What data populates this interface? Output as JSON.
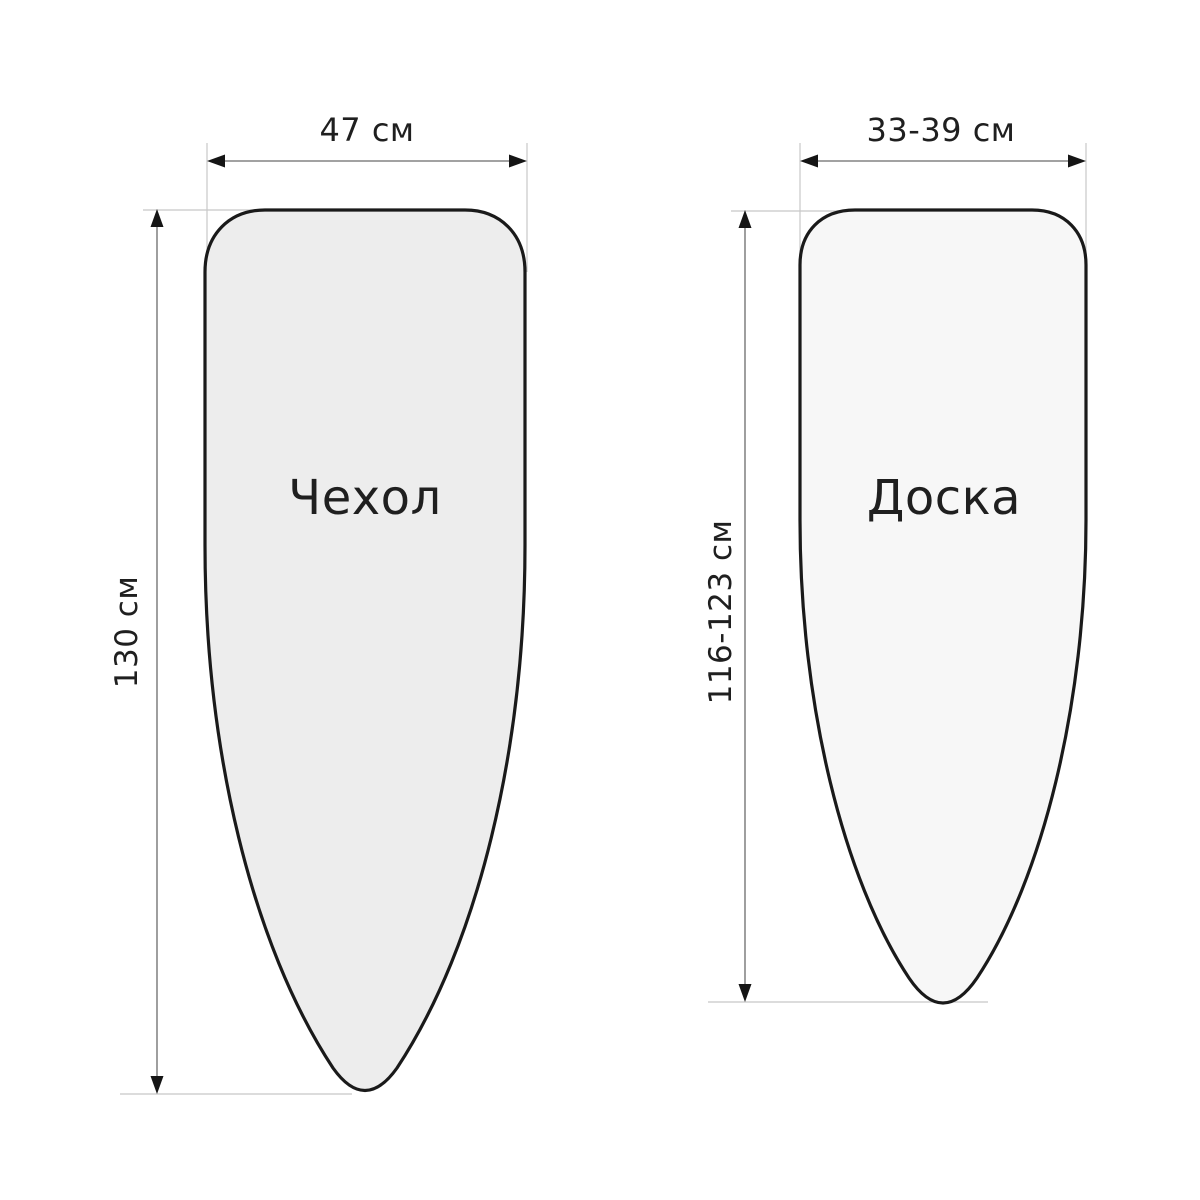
{
  "diagram": {
    "kind": "ironing-board-size-diagram",
    "background": "#ffffff",
    "cover": {
      "label": "Чехол",
      "width_label": "47 см",
      "height_label": "130 см",
      "fill": "#ededed"
    },
    "board": {
      "label": "Доска",
      "width_label": "33-39 см",
      "height_label": "116-123 см",
      "fill": "#f7f7f7"
    },
    "colors": {
      "outline": "#1a1a1a",
      "dimension_line": "#6b6b6b",
      "extension_line": "#c7c7c7",
      "arrowhead": "#151515",
      "text": "#1f1f1f"
    }
  }
}
